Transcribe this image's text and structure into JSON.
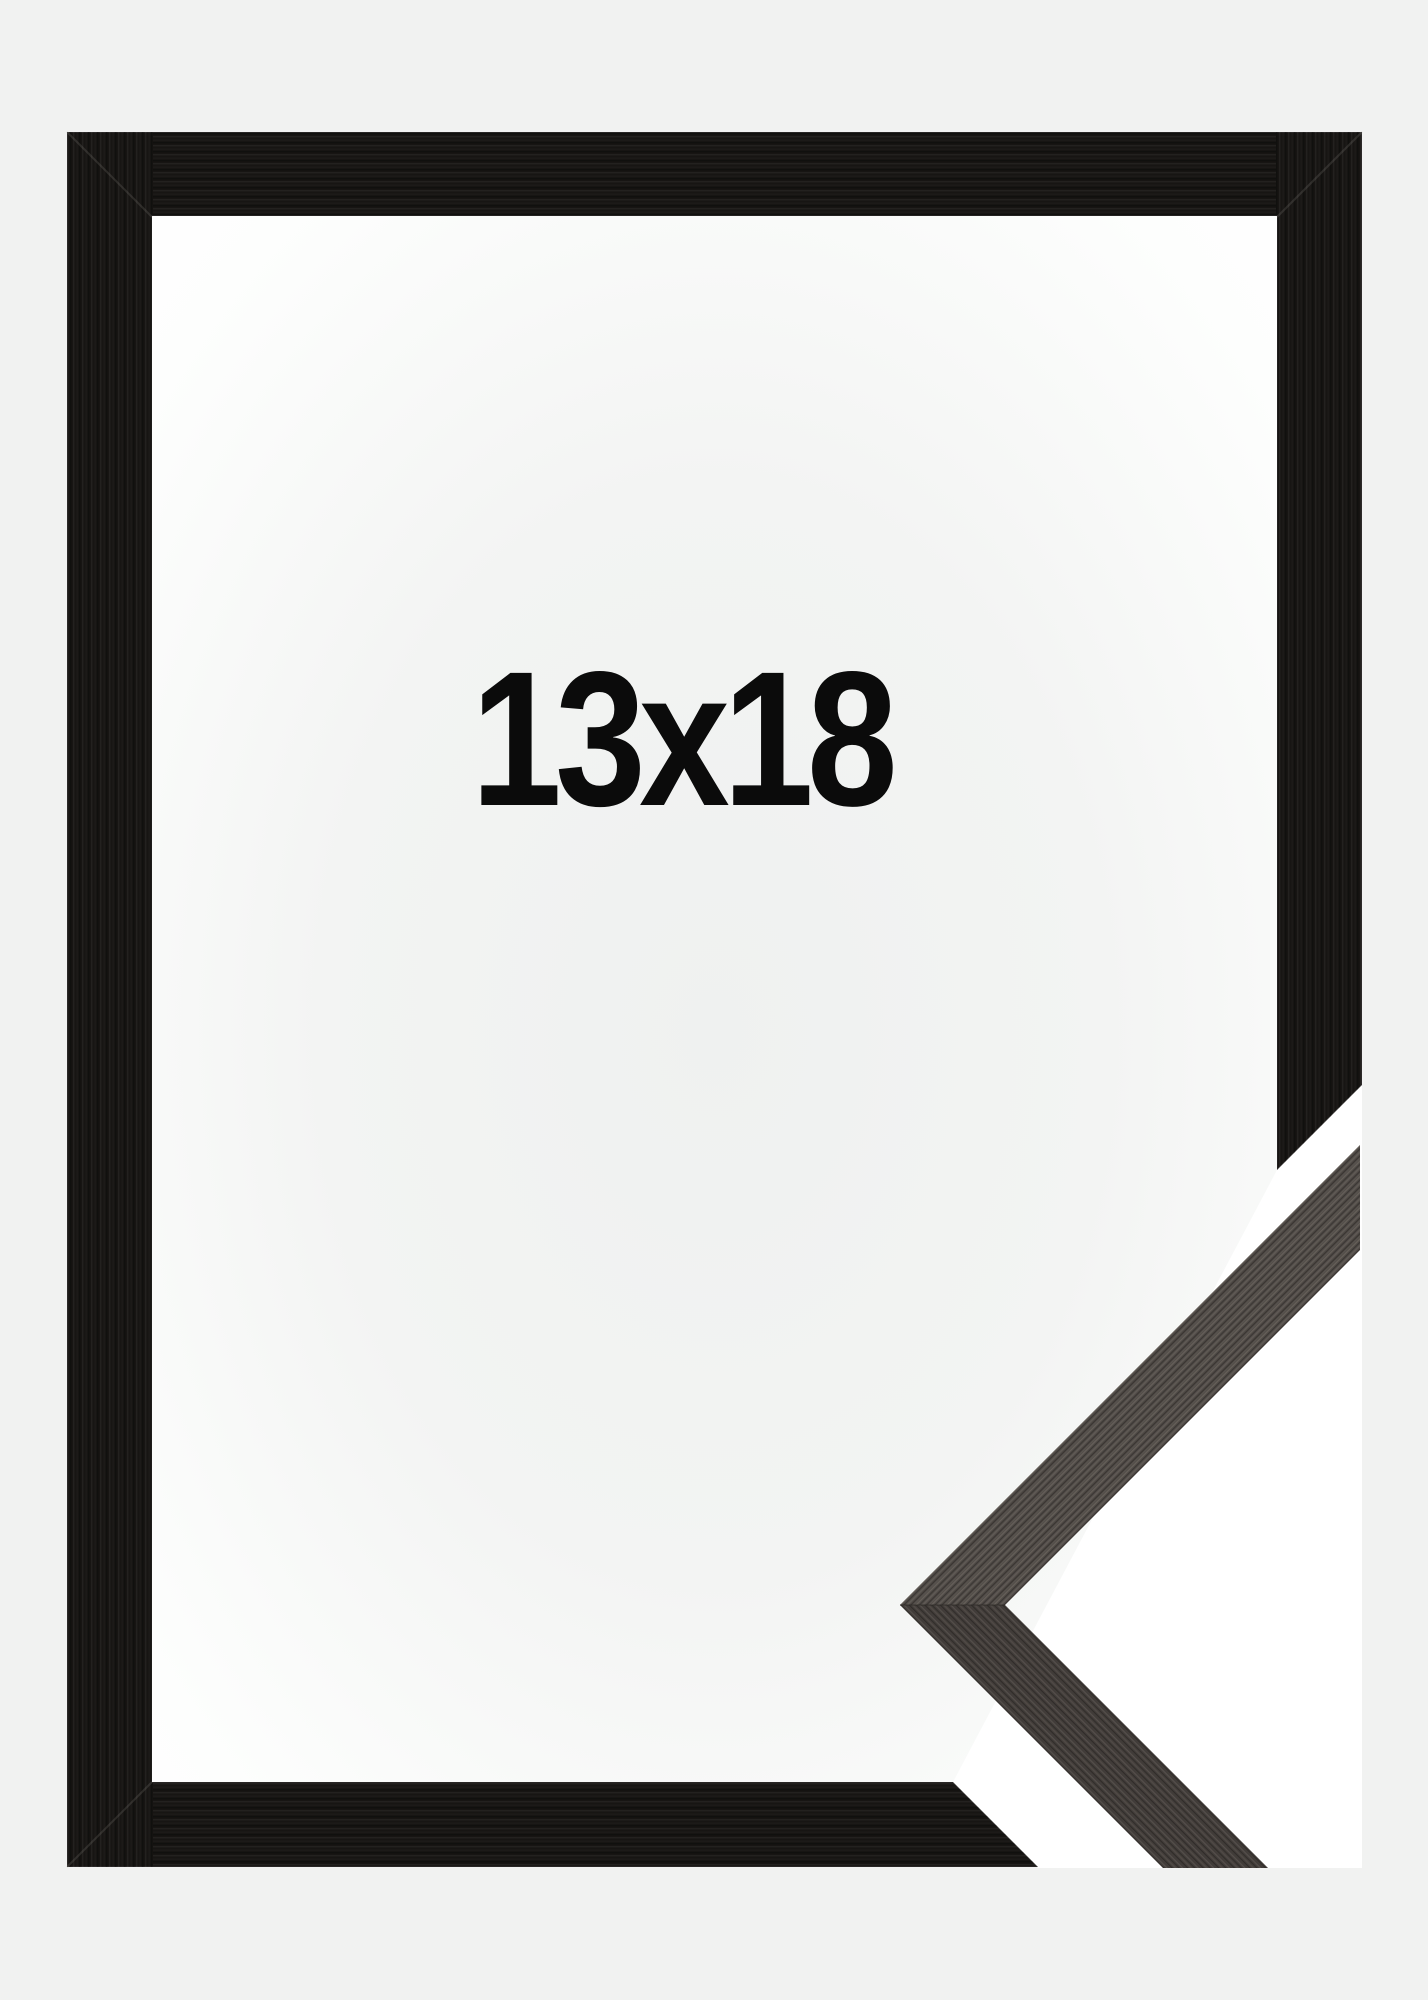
{
  "product_image": {
    "size_label": "13x18",
    "background_color": "#f1f2f1",
    "interior_center_color": "#eff1f0",
    "interior_mid_color": "#f3f4f3",
    "interior_edge_color": "#fdfefd",
    "backing_white": "#ffffff",
    "frame_color": "#171513",
    "frame_edge_highlight": "#ffffff",
    "miter_seam_color": "#8a8681",
    "sample_upper_color": "#4e4945",
    "sample_lower_color": "#413c39",
    "sample_seam_color": "#2b2825",
    "text_color": "#0b0b0b"
  }
}
